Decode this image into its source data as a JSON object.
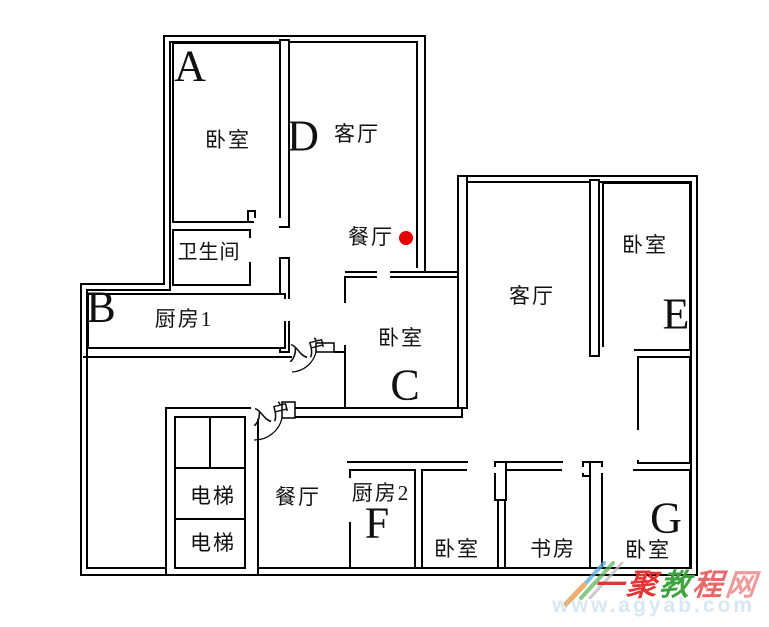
{
  "plan": {
    "rooms": [
      {
        "key": "bedroom-a",
        "label": "卧室",
        "letter": "A"
      },
      {
        "key": "living-left",
        "label": "客厅",
        "letter": "D"
      },
      {
        "key": "dining-top",
        "label": "餐厅"
      },
      {
        "key": "bathroom",
        "label": "卫生间"
      },
      {
        "key": "kitchen-1",
        "label": "厨房1",
        "letter": "B"
      },
      {
        "key": "bedroom-c",
        "label": "卧室",
        "letter": "C"
      },
      {
        "key": "living-right",
        "label": "客厅"
      },
      {
        "key": "bedroom-e",
        "label": "卧室",
        "letter": "E"
      },
      {
        "key": "elevator-1",
        "label": "电梯"
      },
      {
        "key": "elevator-2",
        "label": "电梯"
      },
      {
        "key": "dining-bottom",
        "label": "餐厅"
      },
      {
        "key": "kitchen-2",
        "label": "厨房2",
        "letter": "F"
      },
      {
        "key": "bedroom-bottom",
        "label": "卧室"
      },
      {
        "key": "study",
        "label": "书房"
      },
      {
        "key": "bedroom-g",
        "label": "卧室",
        "letter": "G"
      }
    ],
    "entry_labels": [
      "入户",
      "入户"
    ],
    "marker": {
      "color": "#e60000"
    }
  },
  "watermark": {
    "brand_chars": [
      {
        "t": "一",
        "color": "#e63434"
      },
      {
        "t": "聚",
        "color": "#e63434"
      },
      {
        "t": "教",
        "color": "#3fa43f"
      },
      {
        "t": "程",
        "color": "#e66a6a"
      },
      {
        "t": "网",
        "color": "#f09b9b"
      }
    ],
    "url": "www.agyab.com"
  }
}
